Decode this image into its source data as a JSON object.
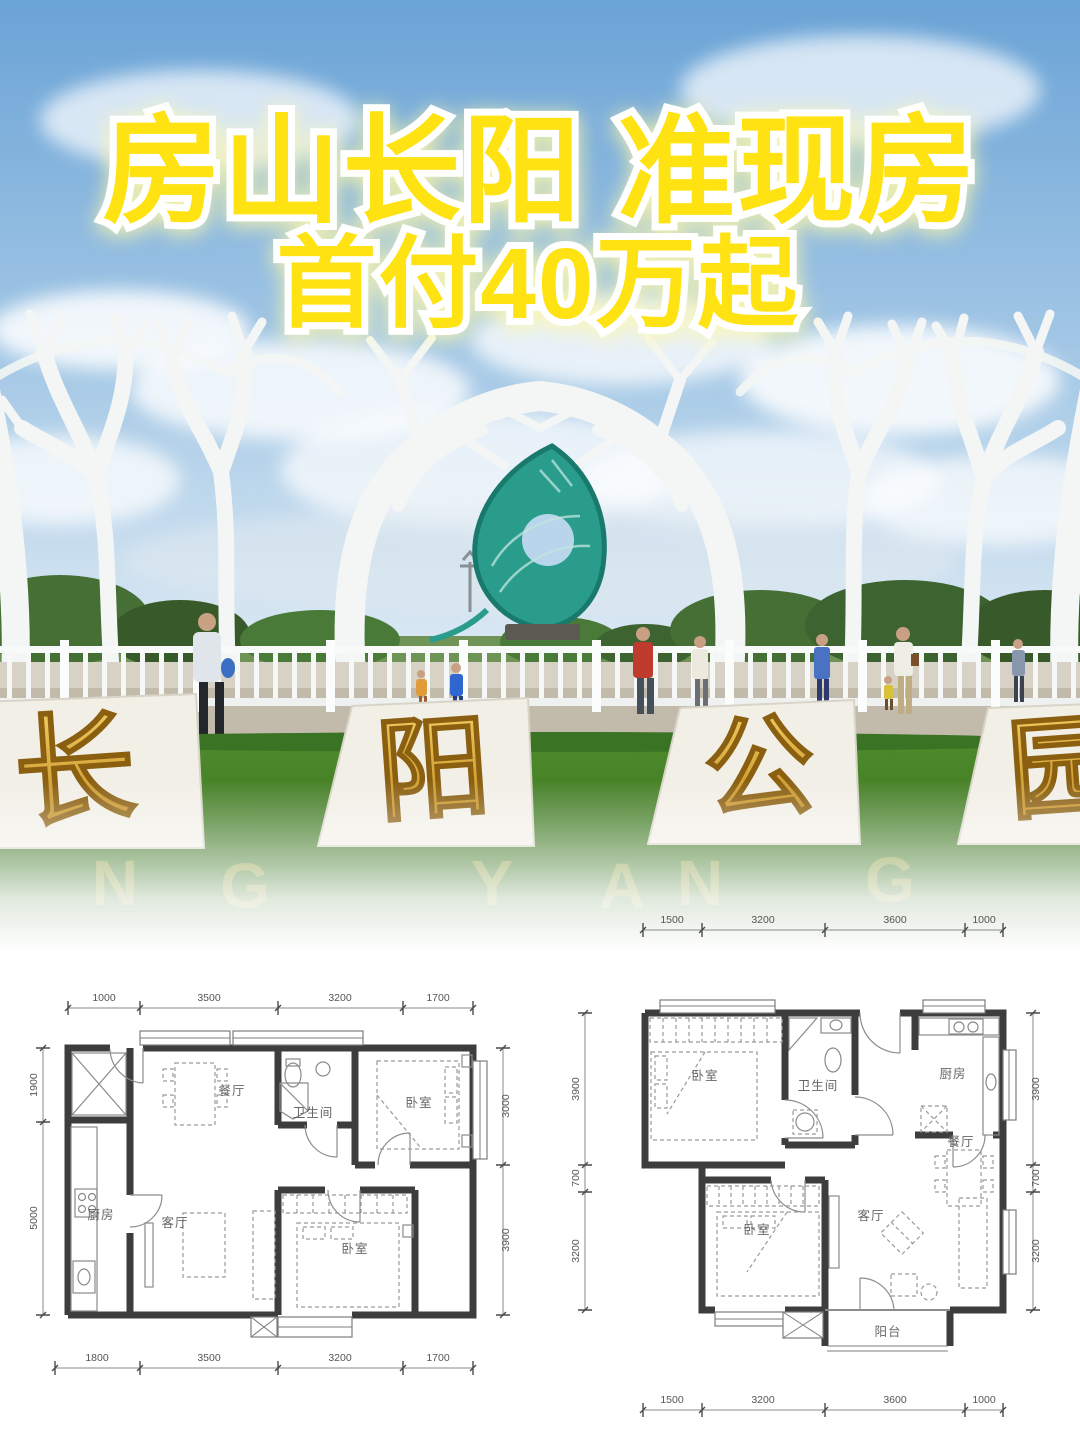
{
  "poster": {
    "headline_line1": "房山长阳 准现房",
    "headline_line2": "首付40万起"
  },
  "park_photo": {
    "monument_chars": [
      "长",
      "阳",
      "公",
      "园"
    ],
    "grass_letters": [
      "N",
      "G",
      "Y",
      "A",
      "N",
      "G"
    ]
  },
  "colors": {
    "headline_yellow": "#ffe211",
    "monument_gold": "#d9a62e",
    "sculpture_teal": "#2f9e8f",
    "plan_wall": "#3d3d3d"
  },
  "floorplan_left": {
    "dims_top": [
      "1000",
      "3500",
      "3200",
      "1700"
    ],
    "dims_bottom": [
      "1800",
      "3500",
      "3200",
      "1700"
    ],
    "dims_left": [
      "1900",
      "5000"
    ],
    "dims_right": [
      "3000",
      "3900"
    ],
    "rooms": {
      "dining": "餐厅",
      "bathroom": "卫生间",
      "bedroom_top": "卧室",
      "kitchen": "厨房",
      "living": "客厅",
      "bedroom_bottom": "卧室"
    }
  },
  "floorplan_right": {
    "dims_top": [
      "1500",
      "3200",
      "3600",
      "1000"
    ],
    "dims_bottom": [
      "1500",
      "3200",
      "3600",
      "1000"
    ],
    "dims_left": [
      "3900",
      "700",
      "3200"
    ],
    "dims_right": [
      "3900",
      "700",
      "3200"
    ],
    "rooms": {
      "bedroom_top": "卧室",
      "bathroom": "卫生间",
      "kitchen": "厨房",
      "dining": "餐厅",
      "bedroom_bottom": "卧室",
      "living": "客厅",
      "balcony": "阳台"
    }
  }
}
